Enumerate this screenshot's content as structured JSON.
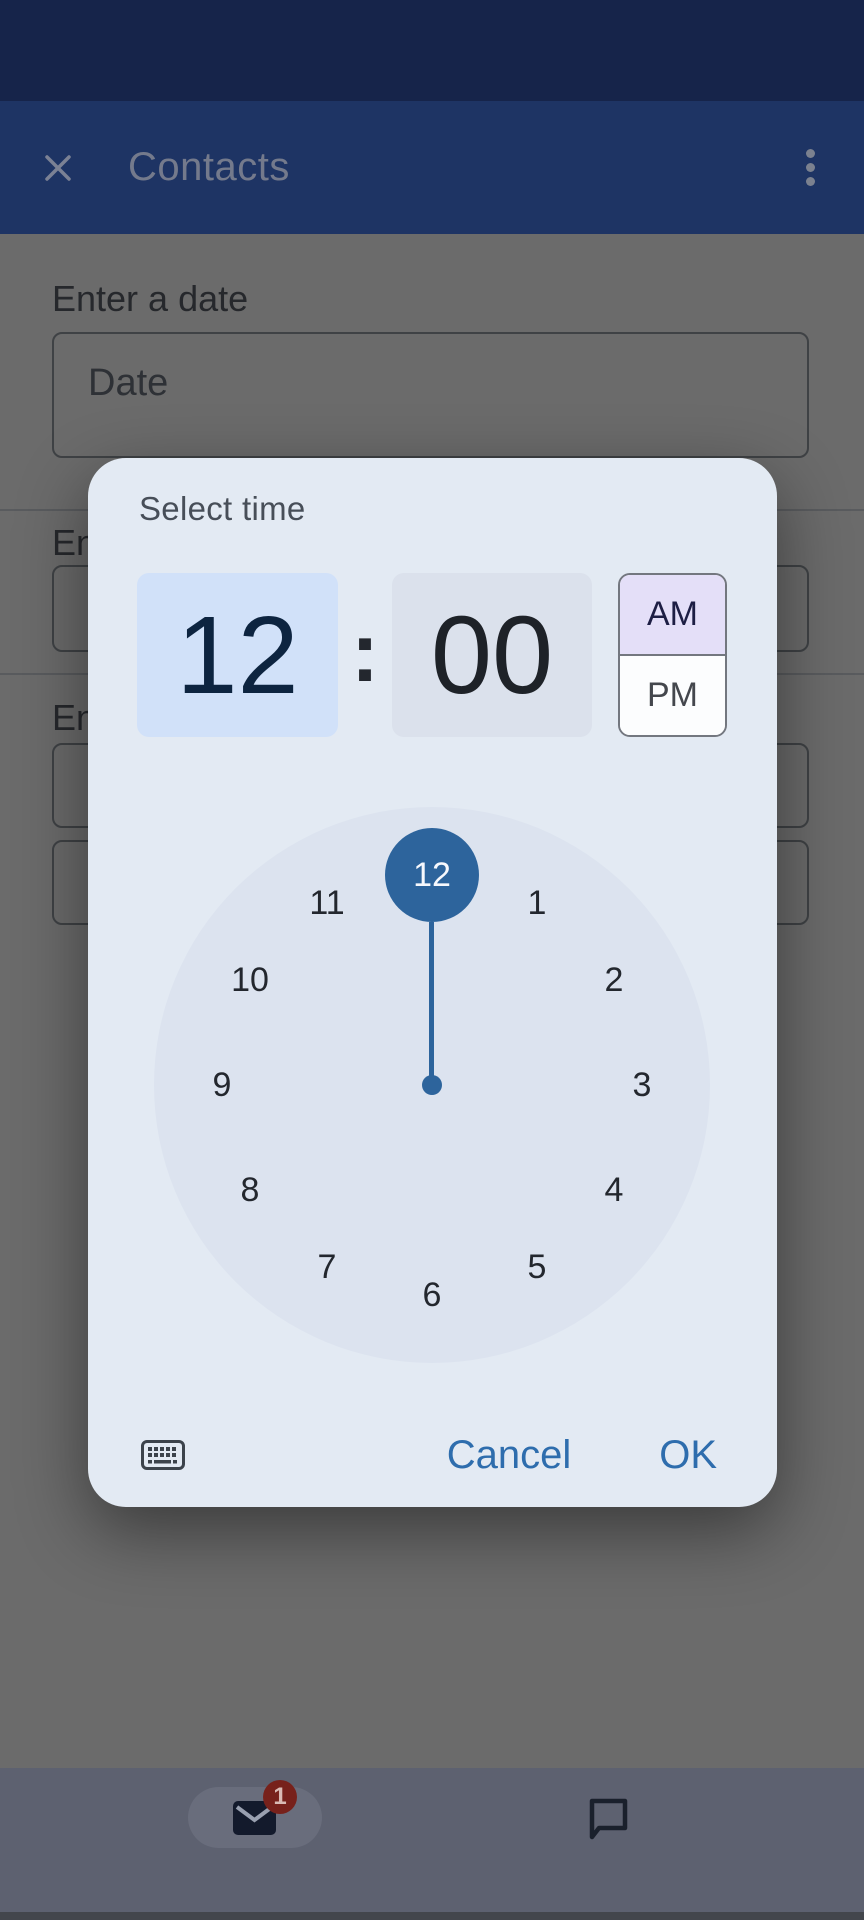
{
  "header": {
    "title": "Contacts"
  },
  "background_form": {
    "date_label": "Enter a date",
    "date_placeholder": "Date",
    "clipped_label_2": "En",
    "clipped_label_3": "En"
  },
  "time_picker": {
    "title": "Select time",
    "hour": "12",
    "separator": ":",
    "minute": "00",
    "am_label": "AM",
    "pm_label": "PM",
    "selected_period": "AM",
    "clock_selected": "12",
    "clock_numbers": [
      "1",
      "2",
      "3",
      "4",
      "5",
      "6",
      "7",
      "8",
      "9",
      "10",
      "11"
    ],
    "cancel_label": "Cancel",
    "ok_label": "OK"
  },
  "navbar": {
    "mail_badge": "1"
  },
  "colors": {
    "accent_blue": "#2d649c",
    "button_blue": "#2e6dad",
    "dialog_bg": "#e3eaf3",
    "hour_field_bg": "#d1e1f9",
    "minute_field_bg": "#dbe1ec",
    "am_selected_bg": "#e4dff8",
    "clock_bg": "#dce3ef",
    "header_bg_dimmed": "#1e3464",
    "status_bar_dimmed": "#16244a",
    "scrim_gray": "#6b6b6b",
    "badge_red_dimmed": "#77211b"
  }
}
